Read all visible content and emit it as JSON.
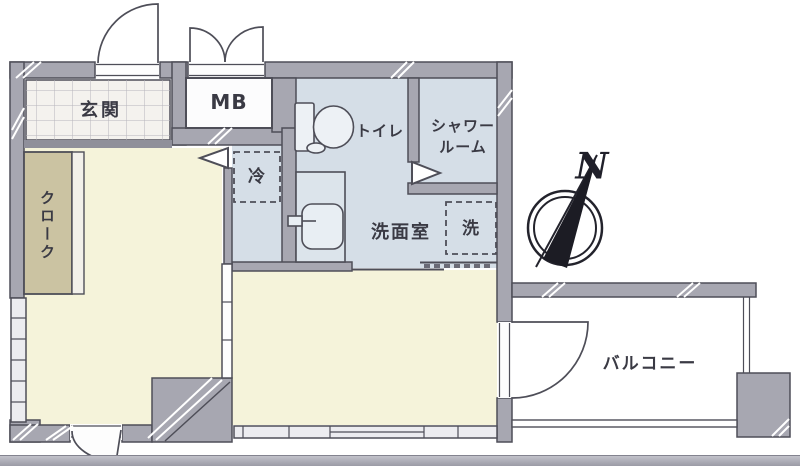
{
  "labels": {
    "entrance": "玄関",
    "meter_box": "MB",
    "toilet": "トイレ",
    "shower_line1": "シャワー",
    "shower_line2": "ルーム",
    "washroom": "洗面室",
    "washer": "洗",
    "refrigerator": "冷",
    "closet": "クローク",
    "balcony": "バルコニー",
    "compass_north": "N"
  },
  "colors": {
    "wall": "#a7a7b1",
    "line": "#4e4e58",
    "cream": "#f5f3da",
    "blue": "#d5dee7",
    "tan": "#cbc3a2",
    "tile": "#f4f2ee",
    "win": "#ececf0",
    "text": "#3a3a44",
    "white": "#fdfdfd"
  }
}
